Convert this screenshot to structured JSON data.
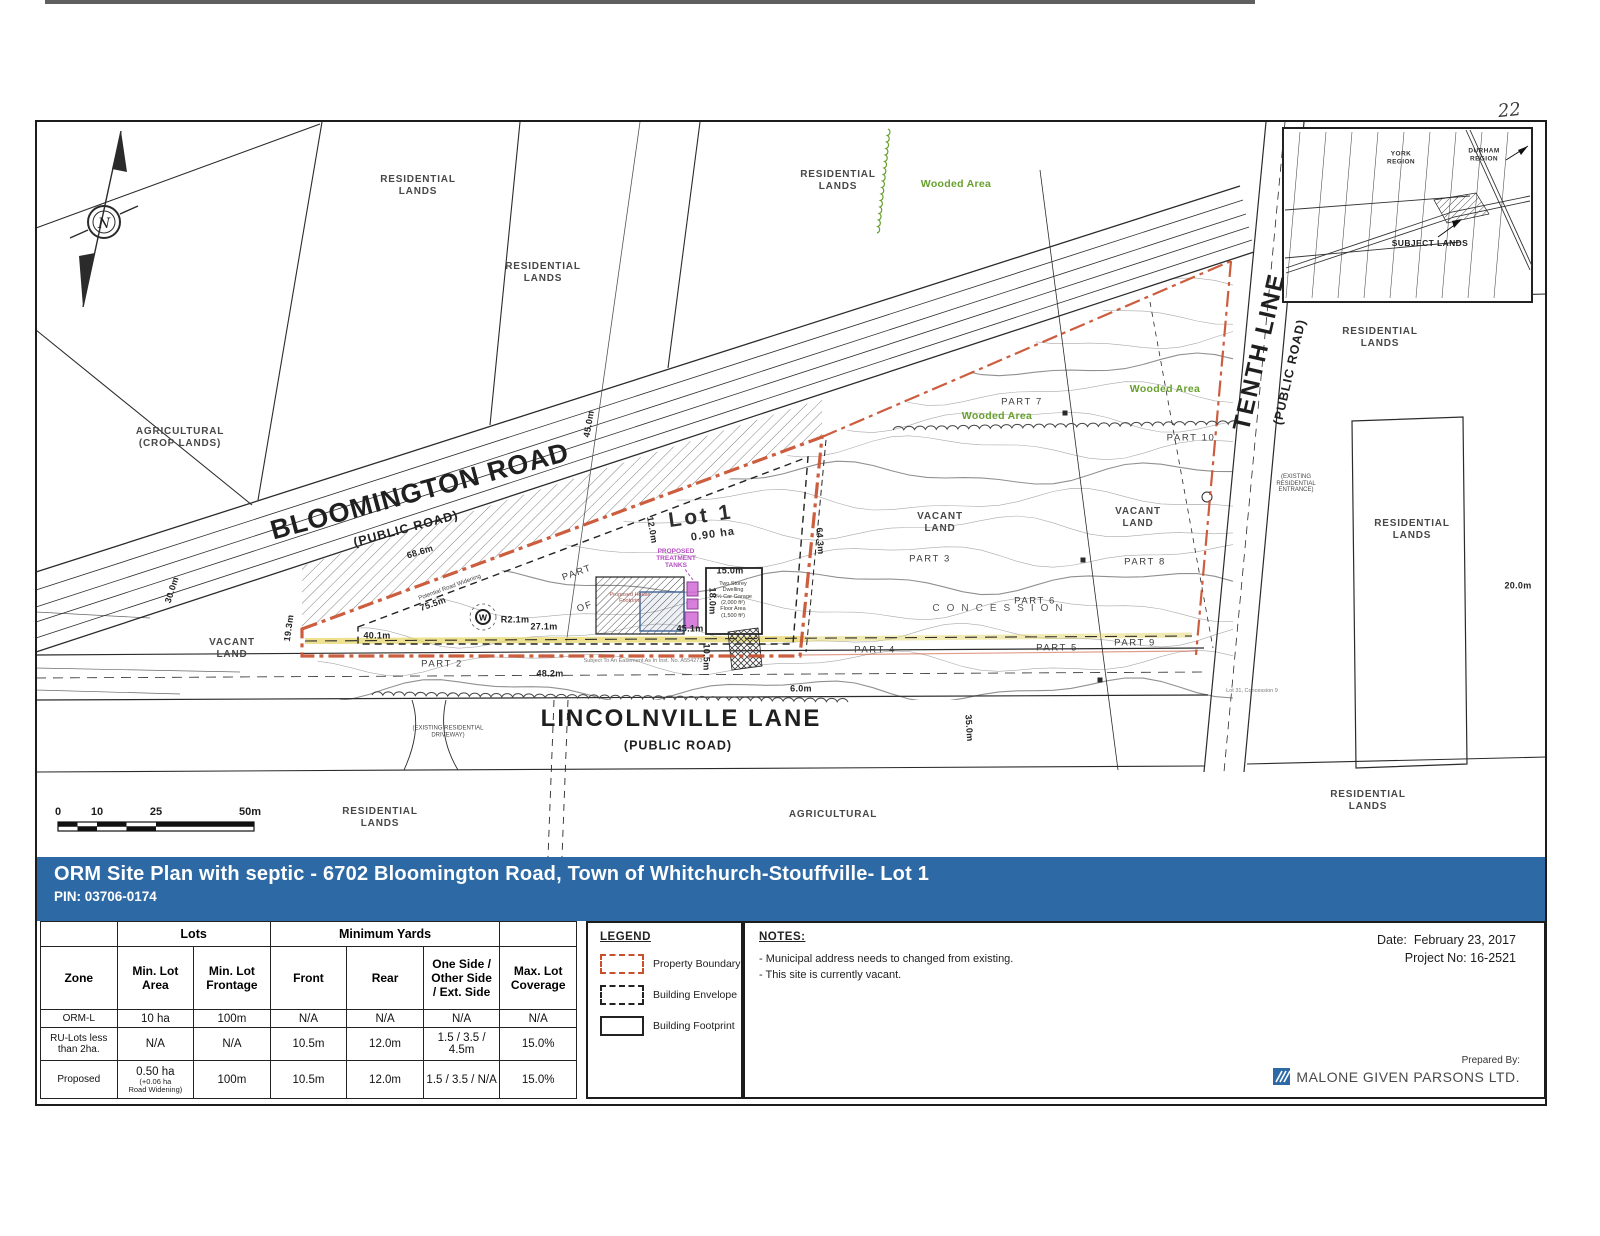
{
  "page": {
    "handwritten_number": "22"
  },
  "title_bar": {
    "title": "ORM Site Plan with septic - 6702 Bloomington Road, Town of Whitchurch-Stouffville- Lot 1",
    "pin": "PIN: 03706-0174"
  },
  "map": {
    "colors": {
      "boundary": "#c8502f",
      "wooded": "#68a02e",
      "tanks": "#cf67d3",
      "highlight": "#e7d76a",
      "banner": "#2d6aa5"
    },
    "lot": {
      "label": "Lot 1",
      "area": "0.90 ha"
    },
    "scale": {
      "ticks": [
        {
          "t": "0",
          "x": 58
        },
        {
          "t": "10",
          "x": 97
        },
        {
          "t": "25",
          "x": 156
        },
        {
          "t": "50m",
          "x": 250
        }
      ]
    },
    "labels": [
      {
        "name": "bloomington-road-label",
        "text": "BLOOMINGTON ROAD",
        "x": 420,
        "y": 492,
        "rot": -15,
        "cls": "road-big"
      },
      {
        "name": "bloomington-road-sub",
        "text": "(PUBLIC ROAD)",
        "x": 406,
        "y": 529,
        "rot": -15,
        "cls": "road-sub"
      },
      {
        "name": "lincolnville-lane-label",
        "text": "LINCOLNVILLE LANE",
        "x": 681,
        "y": 719,
        "rot": 0,
        "cls": "road-med"
      },
      {
        "name": "lincolnville-lane-sub",
        "text": "(PUBLIC ROAD)",
        "x": 678,
        "y": 746,
        "rot": 0,
        "cls": "road-sub"
      },
      {
        "name": "tenth-line-label",
        "text": "TENTH LINE",
        "x": 1260,
        "y": 352,
        "rot": -77,
        "cls": "road-med"
      },
      {
        "name": "tenth-line-sub",
        "text": "(PUBLIC ROAD)",
        "x": 1290,
        "y": 372,
        "rot": -77,
        "cls": "road-sub"
      },
      {
        "name": "residential-lands-topleft-1",
        "text": "RESIDENTIAL\nLANDS",
        "x": 418,
        "y": 186,
        "cls": "land"
      },
      {
        "name": "residential-lands-topleft-2",
        "text": "RESIDENTIAL\nLANDS",
        "x": 543,
        "y": 273,
        "cls": "land"
      },
      {
        "name": "residential-lands-top",
        "text": "RESIDENTIAL\nLANDS",
        "x": 838,
        "y": 181,
        "cls": "land"
      },
      {
        "name": "agricultural-crop-lands",
        "text": "AGRICULTURAL\n(CROP LANDS)",
        "x": 180,
        "y": 438,
        "cls": "land"
      },
      {
        "name": "vacant-land-left",
        "text": "VACANT\nLAND",
        "x": 232,
        "y": 649,
        "cls": "land"
      },
      {
        "name": "vacant-land-mid",
        "text": "VACANT\nLAND",
        "x": 940,
        "y": 523,
        "cls": "land"
      },
      {
        "name": "vacant-land-right",
        "text": "VACANT\nLAND",
        "x": 1138,
        "y": 518,
        "cls": "land"
      },
      {
        "name": "residential-lands-right-upper",
        "text": "RESIDENTIAL\nLANDS",
        "x": 1380,
        "y": 338,
        "cls": "land"
      },
      {
        "name": "residential-lands-right-mid",
        "text": "RESIDENTIAL\nLANDS",
        "x": 1412,
        "y": 530,
        "cls": "land"
      },
      {
        "name": "residential-lands-bottom-left",
        "text": "RESIDENTIAL\nLANDS",
        "x": 380,
        "y": 818,
        "cls": "land"
      },
      {
        "name": "agricultural-bottom",
        "text": "AGRICULTURAL",
        "x": 833,
        "y": 815,
        "cls": "land"
      },
      {
        "name": "residential-lands-bottom-right",
        "text": "RESIDENTIAL\nLANDS",
        "x": 1368,
        "y": 801,
        "cls": "land"
      },
      {
        "name": "wooded-area-top",
        "text": "Wooded Area",
        "x": 956,
        "y": 184,
        "cls": "green"
      },
      {
        "name": "wooded-area-mid",
        "text": "Wooded Area",
        "x": 997,
        "y": 416,
        "cls": "green"
      },
      {
        "name": "wooded-area-right",
        "text": "Wooded Area",
        "x": 1165,
        "y": 389,
        "cls": "green"
      },
      {
        "name": "part-2",
        "text": "PART 2",
        "x": 442,
        "y": 664,
        "cls": "part"
      },
      {
        "name": "part-3",
        "text": "PART 3",
        "x": 930,
        "y": 559,
        "cls": "part"
      },
      {
        "name": "part-4",
        "text": "PART 4",
        "x": 875,
        "y": 650,
        "cls": "part"
      },
      {
        "name": "part-5",
        "text": "PART 5",
        "x": 1057,
        "y": 648,
        "cls": "part"
      },
      {
        "name": "part-6",
        "text": "PART 6",
        "x": 1035,
        "y": 601,
        "cls": "part"
      },
      {
        "name": "part-7",
        "text": "PART 7",
        "x": 1022,
        "y": 402,
        "cls": "part"
      },
      {
        "name": "part-8",
        "text": "PART 8",
        "x": 1145,
        "y": 562,
        "cls": "part"
      },
      {
        "name": "part-9",
        "text": "PART 9",
        "x": 1135,
        "y": 643,
        "cls": "part"
      },
      {
        "name": "part-10",
        "text": "PART 10",
        "x": 1191,
        "y": 438,
        "cls": "part"
      },
      {
        "name": "part-word",
        "text": "PART",
        "x": 577,
        "y": 573,
        "rot": -20,
        "cls": "part"
      },
      {
        "name": "of-word",
        "text": "OF",
        "x": 585,
        "y": 607,
        "rot": -20,
        "cls": "part"
      },
      {
        "name": "concession",
        "text": "CONCESSION",
        "x": 1001,
        "y": 609,
        "cls": "concession"
      },
      {
        "name": "lot-1-label",
        "text": "Lot 1",
        "x": 701,
        "y": 517,
        "rot": -8,
        "cls": "lot-title"
      },
      {
        "name": "lot-1-area",
        "text": "0.90 ha",
        "x": 713,
        "y": 535,
        "rot": -8,
        "cls": "lot-area"
      },
      {
        "name": "dim-30-0m",
        "text": "30.0m",
        "x": 172,
        "y": 590,
        "rot": -72,
        "cls": "dim"
      },
      {
        "name": "dim-19-3m",
        "text": "19.3m",
        "x": 289,
        "y": 628,
        "rot": -82,
        "cls": "dim"
      },
      {
        "name": "dim-45-0m",
        "text": "45.0m",
        "x": 589,
        "y": 424,
        "rot": -80,
        "cls": "dim"
      },
      {
        "name": "dim-68-6m",
        "text": "68.6m",
        "x": 420,
        "y": 552,
        "rot": -17,
        "cls": "dim"
      },
      {
        "name": "dim-75-5m",
        "text": "75.5m",
        "x": 433,
        "y": 604,
        "rot": -19,
        "cls": "dim"
      },
      {
        "name": "dim-40-1m",
        "text": "40.1m",
        "x": 377,
        "y": 636,
        "rot": 0,
        "cls": "dim"
      },
      {
        "name": "dim-r2-1m",
        "text": "R2.1m",
        "x": 515,
        "y": 620,
        "rot": 0,
        "cls": "dim"
      },
      {
        "name": "dim-27-1m",
        "text": "27.1m",
        "x": 544,
        "y": 627,
        "rot": 0,
        "cls": "dim"
      },
      {
        "name": "dim-48-2m",
        "text": "48.2m",
        "x": 550,
        "y": 674,
        "rot": 0,
        "cls": "dim"
      },
      {
        "name": "dim-15-0m",
        "text": "15.0m",
        "x": 730,
        "y": 571,
        "rot": 0,
        "cls": "dim"
      },
      {
        "name": "dim-18-0m",
        "text": "18.0m",
        "x": 712,
        "y": 601,
        "rot": 90,
        "cls": "dim"
      },
      {
        "name": "dim-12-0m",
        "text": "12.0m",
        "x": 652,
        "y": 530,
        "rot": 80,
        "cls": "dim"
      },
      {
        "name": "dim-10-5m",
        "text": "10.5m",
        "x": 706,
        "y": 657,
        "rot": 90,
        "cls": "dim"
      },
      {
        "name": "dim-45-1m",
        "text": "45.1m",
        "x": 690,
        "y": 629,
        "rot": 0,
        "cls": "dim"
      },
      {
        "name": "dim-64-3m",
        "text": "64.3m",
        "x": 820,
        "y": 541,
        "rot": 86,
        "cls": "dim"
      },
      {
        "name": "dim-6-0m",
        "text": "6.0m",
        "x": 801,
        "y": 689,
        "rot": 0,
        "cls": "dim"
      },
      {
        "name": "dim-35-0m",
        "text": "35.0m",
        "x": 969,
        "y": 728,
        "rot": 86,
        "cls": "dim"
      },
      {
        "name": "dim-20-0m",
        "text": "20.0m",
        "x": 1518,
        "y": 586,
        "rot": 0,
        "cls": "dim"
      },
      {
        "name": "potential-road-widening",
        "text": "Potential Road Widening",
        "x": 450,
        "y": 588,
        "rot": -20,
        "cls": "tiny"
      },
      {
        "name": "proposed-treatment-tanks",
        "text": "PROPOSED\nTREATMENT\nTANKS",
        "x": 676,
        "y": 559,
        "cls": "magenta"
      },
      {
        "name": "existing-residential-driveway",
        "text": "(EXISTING RESIDENTIAL\nDRIVEWAY)",
        "x": 448,
        "y": 732,
        "cls": "tiny"
      },
      {
        "name": "existing-residential-entrance",
        "text": "(EXISTING\nRESIDENTIAL\nENTRANCE)",
        "x": 1296,
        "y": 484,
        "cls": "tiny"
      },
      {
        "name": "easement-note",
        "text": "Subject To An Easement As In Inst. No. A554273",
        "x": 643,
        "y": 661,
        "cls": "tiny-gray"
      },
      {
        "name": "dwelling-note",
        "text": "Two Storey\nDwelling\n2½ Car Garage\n(2,000 ft²)\nFloor Area\n(1,500 ft²)",
        "x": 733,
        "y": 600,
        "cls": "env"
      },
      {
        "name": "footprint-note",
        "text": "Proposed House\nFootprint",
        "x": 630,
        "y": 598,
        "cls": "foot"
      },
      {
        "name": "lot-concession-note",
        "text": "Lot 31, Concession 9",
        "x": 1252,
        "y": 691,
        "cls": "tiny-gray"
      },
      {
        "name": "inset-york-region",
        "text": "YORK\nREGION",
        "x": 1401,
        "y": 158,
        "cls": "inset"
      },
      {
        "name": "inset-durham-region",
        "text": "DURHAM\nREGION",
        "x": 1484,
        "y": 155,
        "cls": "inset"
      },
      {
        "name": "inset-subject-lands",
        "text": "SUBJECT LANDS",
        "x": 1430,
        "y": 243,
        "cls": "inset-subject"
      }
    ]
  },
  "legend": {
    "title": "LEGEND",
    "items": [
      {
        "label": "Property Boundary",
        "style": "property-boundary"
      },
      {
        "label": "Building Envelope",
        "style": "building-envelope"
      },
      {
        "label": "Building Footprint",
        "style": "building-footprint"
      }
    ]
  },
  "notes": {
    "title": "NOTES:",
    "items": [
      "- Municipal address needs to changed from existing.",
      "- This site is currently vacant."
    ]
  },
  "meta": {
    "date_label": "Date:",
    "date_value": "February 23, 2017",
    "project_label": "Project No:",
    "project_value": "16-2521",
    "prepared_label": "Prepared By:",
    "company": "MALONE GIVEN PARSONS LTD."
  },
  "table": {
    "group_headers": [
      {
        "label": "",
        "span": 1
      },
      {
        "label": "Lots",
        "span": 2
      },
      {
        "label": "Minimum Yards",
        "span": 3
      },
      {
        "label": "",
        "span": 1
      }
    ],
    "columns": [
      "Zone",
      "Min. Lot\nArea",
      "Min. Lot\nFrontage",
      "Front",
      "Rear",
      "One Side /\nOther Side\n/ Ext. Side",
      "Max. Lot\nCoverage"
    ],
    "rows": [
      [
        "ORM-L",
        "10 ha",
        "100m",
        "N/A",
        "N/A",
        "N/A",
        "N/A"
      ],
      [
        "RU-Lots less\nthan 2ha.",
        "N/A",
        "N/A",
        "10.5m",
        "12.0m",
        "1.5 / 3.5 / 4.5m",
        "15.0%"
      ],
      [
        "Proposed",
        {
          "main": "0.50 ha",
          "sub": "(+0.06 ha\nRoad Widening)"
        },
        "100m",
        "10.5m",
        "12.0m",
        "1.5 / 3.5 / N/A",
        "15.0%"
      ]
    ]
  }
}
